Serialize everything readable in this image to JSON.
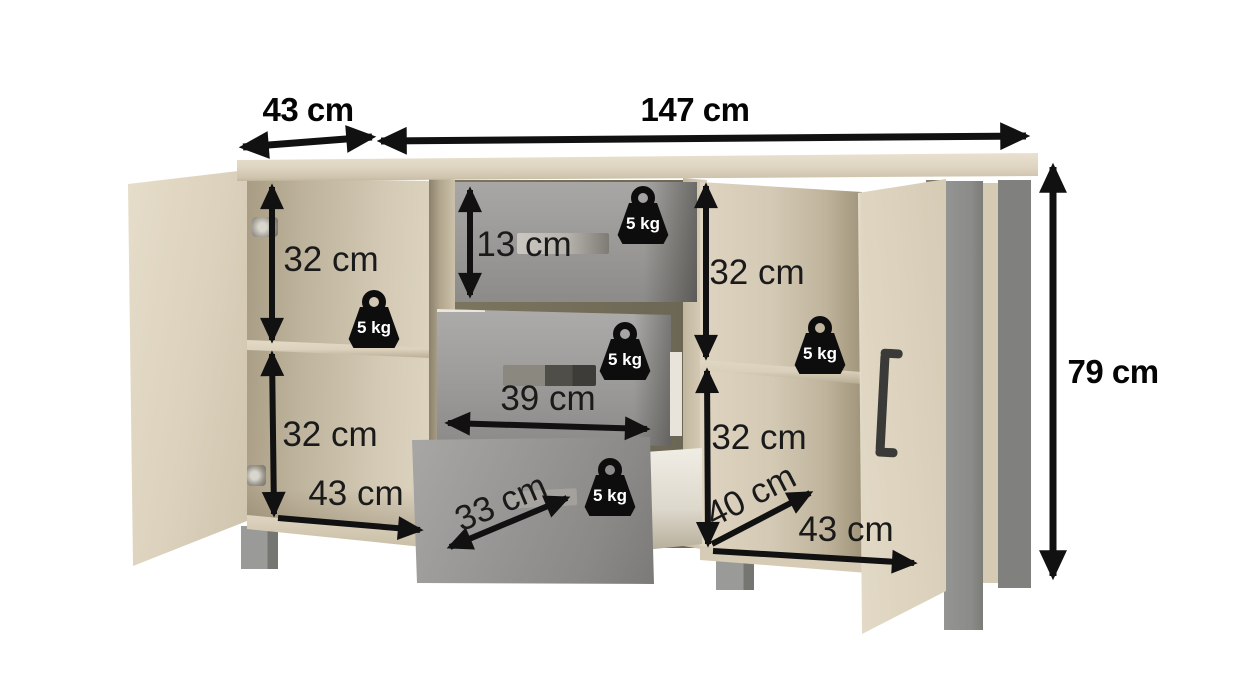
{
  "diagram_type": "furniture dimension diagram (sideboard with 2 doors and 3 drawers)",
  "background": "#ffffff",
  "annotation_color": "#121212",
  "colors": {
    "wood_light": "#ddd3c0",
    "wood_mid": "#d3c9b4",
    "wood_shadow": "#a89c84",
    "drawer_front_gray": "#9b9a98",
    "leg_gray": "#8c8c8a",
    "leg_dark_gray": "#7e7e7c",
    "weight_icon_bg": "#0d0d0d",
    "weight_icon_text": "#ffffff"
  },
  "dimensions": {
    "top_left_width": {
      "text": "43 cm",
      "cm": 43
    },
    "total_width": {
      "text": "147 cm",
      "cm": 147
    },
    "height": {
      "text": "79 cm",
      "cm": 79
    },
    "left_upper_section": {
      "text": "32 cm",
      "cm": 32
    },
    "left_lower_section": {
      "text": "32 cm",
      "cm": 32
    },
    "top_drawer_height": {
      "text": "13 cm",
      "cm": 13
    },
    "right_upper_section": {
      "text": "32 cm",
      "cm": 32
    },
    "right_lower_section": {
      "text": "32 cm",
      "cm": 32
    },
    "drawer_width": {
      "text": "39 cm",
      "cm": 39
    },
    "drawer_diagonal": {
      "text": "33 cm",
      "cm": 33
    },
    "left_section_depth": {
      "text": "43 cm",
      "cm": 43
    },
    "right_section_depth": {
      "text": "40 cm",
      "cm": 40
    },
    "right_section_width": {
      "text": "43 cm",
      "cm": 43
    }
  },
  "load": {
    "text": "5 kg",
    "kg": 5,
    "count": 5
  }
}
